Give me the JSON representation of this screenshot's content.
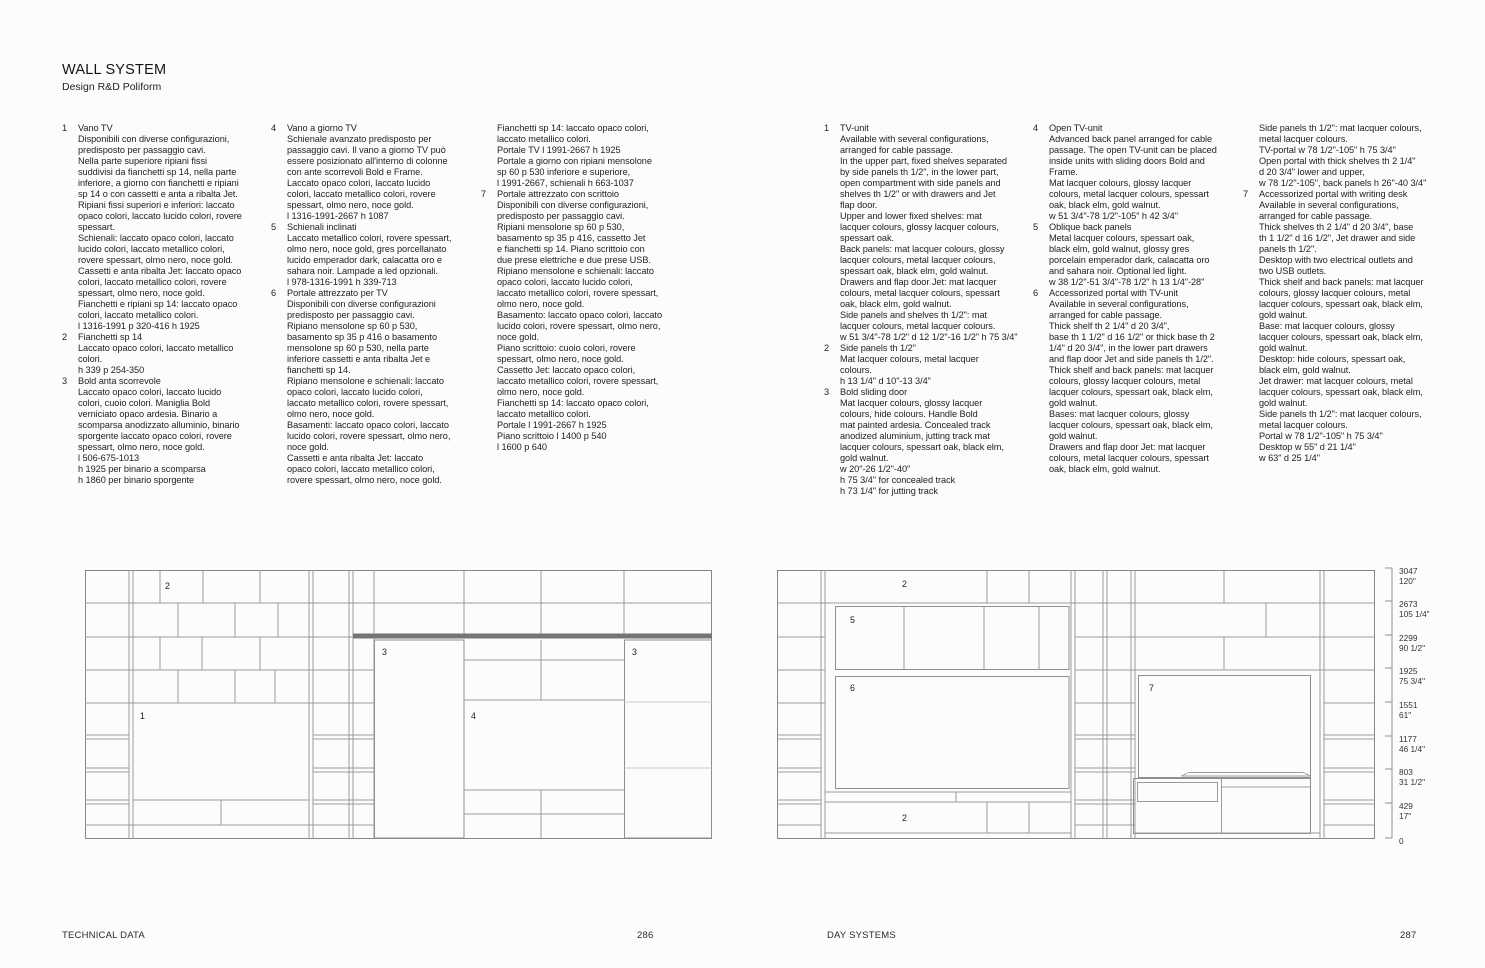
{
  "header": {
    "title": "WALL SYSTEM",
    "subtitle": "Design R&D Poliform"
  },
  "columns": [
    {
      "lang": "it",
      "blocks": [
        {
          "num": "1",
          "lines": [
            "Vano TV",
            "Disponibili con diverse configurazioni,",
            "predisposto per passaggio cavi.",
            "Nella parte superiore ripiani fissi",
            "suddivisi da fianchetti sp 14, nella parte",
            "inferiore, a giorno con fianchetti e ripiani",
            "sp 14 o con cassetti e anta a ribalta Jet.",
            "Ripiani fissi superiori e inferiori: laccato",
            "opaco colori, laccato lucido colori, rovere",
            "spessart.",
            "Schienali: laccato opaco colori, laccato",
            "lucido colori, laccato metallico colori,",
            "rovere spessart, olmo nero, noce gold.",
            "Cassetti e anta ribalta Jet: laccato opaco",
            "colori, laccato metallico colori, rovere",
            "spessart, olmo nero, noce gold.",
            "Fianchetti e ripiani sp 14: laccato opaco",
            "colori, laccato metallico colori.",
            "l 1316-1991 p 320-416 h 1925"
          ]
        },
        {
          "num": "2",
          "lines": [
            "Fianchetti sp 14",
            "Laccato opaco colori, laccato metallico",
            "colori.",
            "h 339 p 254-350"
          ]
        },
        {
          "num": "3",
          "lines": [
            "Bold anta scorrevole",
            "Laccato opaco colori, laccato lucido",
            "colori, cuoio colori. Maniglia Bold",
            "verniciato opaco ardesia. Binario a",
            "scomparsa anodizzato alluminio, binario",
            "sporgente laccato opaco colori, rovere",
            "spessart, olmo nero, noce gold.",
            "l 506-675-1013",
            "h 1925 per binario a scomparsa",
            "h 1860 per binario sporgente"
          ]
        }
      ]
    },
    {
      "lang": "it",
      "blocks": [
        {
          "num": "4",
          "lines": [
            "Vano a giorno TV",
            "Schienale avanzato predisposto per",
            "passaggio cavi. Il vano a giorno TV può",
            "essere posizionato all'interno di colonne",
            "con ante scorrevoli Bold e Frame.",
            "Laccato opaco colori, laccato lucido",
            "colori, laccato metallico colori, rovere",
            "spessart, olmo nero, noce gold.",
            "l 1316-1991-2667 h 1087"
          ]
        },
        {
          "num": "5",
          "lines": [
            "Schienali inclinati",
            "Laccato metallico colori, rovere spessart,",
            "olmo nero, noce gold, gres porcellanato",
            "lucido emperador dark, calacatta oro e",
            "sahara noir. Lampade a led opzionali.",
            "l 978-1316-1991 h 339-713"
          ]
        },
        {
          "num": "6",
          "lines": [
            "Portale attrezzato per TV",
            "Disponibili con diverse configurazioni",
            "predisposto per passaggio cavi.",
            "Ripiano mensolone sp 60 p 530,",
            "basamento sp 35 p 416 o basamento",
            "mensolone sp 60 p 530, nella parte",
            "inferiore cassetti e anta ribalta Jet e",
            "fianchetti sp 14.",
            "Ripiano mensolone e schienali: laccato",
            "opaco colori, laccato lucido colori,",
            "laccato metallico colori, rovere spessart,",
            "olmo nero, noce gold.",
            "Basamenti: laccato opaco colori, laccato",
            "lucido colori, rovere spessart, olmo nero,",
            "noce gold.",
            "Cassetti e anta ribalta Jet: laccato",
            "opaco colori, laccato metallico colori,",
            "rovere spessart, olmo nero, noce gold."
          ]
        }
      ]
    },
    {
      "lang": "it",
      "blocks": [
        {
          "num": "",
          "lines": [
            "Fianchetti sp 14: laccato opaco colori,",
            "laccato metallico colori.",
            "Portale TV l 1991-2667 h 1925",
            "Portale a giorno con ripiani mensolone",
            "sp 60 p 530 inferiore e superiore,",
            "l 1991-2667, schienali h 663-1037"
          ]
        },
        {
          "num": "7",
          "lines": [
            "Portale attrezzato con scrittoio",
            "Disponibili con diverse configurazioni,",
            "predisposto per passaggio cavi.",
            "Ripiani mensolone sp 60 p 530,",
            "basamento sp 35 p 416, cassetto Jet",
            "e fianchetti sp 14. Piano scrittoio con",
            "due prese elettriche e due prese USB.",
            "Ripiano mensolone e schienali: laccato",
            "opaco colori, laccato lucido colori,",
            "laccato metallico colori, rovere spessart,",
            "olmo nero, noce gold.",
            "Basamento: laccato opaco colori, laccato",
            "lucido colori, rovere spessart, olmo nero,",
            "noce gold.",
            "Piano scrittoio: cuoio colori, rovere",
            "spessart, olmo nero, noce gold.",
            "Cassetto Jet: laccato opaco colori,",
            "laccato metallico colori, rovere spessart,",
            "olmo nero, noce gold.",
            "Fianchetti sp 14: laccato opaco colori,",
            "laccato metallico colori.",
            "Portale l 1991-2667 h 1925",
            "Piano scrittoio l 1400 p 540",
            "l 1600 p 640"
          ]
        }
      ]
    },
    {
      "lang": "en",
      "blocks": [
        {
          "num": "1",
          "lines": [
            "TV-unit",
            "Available with several configurations,",
            "arranged for cable passage.",
            "In the upper part, fixed shelves separated",
            "by side panels th 1/2\", in the lower part,",
            "open compartment with side panels and",
            "shelves th 1/2\" or with drawers and Jet",
            "flap door.",
            "Upper and lower fixed shelves: mat",
            "lacquer colours, glossy lacquer colours,",
            "spessart oak.",
            "Back panels: mat lacquer colours, glossy",
            "lacquer colours, metal lacquer colours,",
            "spessart oak, black elm, gold walnut.",
            "Drawers and flap door Jet: mat lacquer",
            "colours, metal lacquer colours, spessart",
            "oak, black elm, gold walnut.",
            "Side panels and shelves th 1/2\": mat",
            "lacquer colours, metal lacquer colours.",
            "w 51 3/4\"-78 1/2\" d 12 1/2\"-16 1/2\" h 75 3/4\""
          ]
        },
        {
          "num": "2",
          "lines": [
            "Side panels th 1/2\"",
            "Mat lacquer colours, metal lacquer",
            "colours.",
            "h 13 1/4\" d 10\"-13 3/4\""
          ]
        },
        {
          "num": "3",
          "lines": [
            "Bold sliding door",
            "Mat lacquer colours, glossy lacquer",
            "colours, hide colours. Handle Bold",
            "mat painted ardesia. Concealed track",
            "anodized aluminium, jutting track mat",
            "lacquer colours, spessart oak, black elm,",
            "gold walnut.",
            "w 20\"-26 1/2\"-40\"",
            "h 75 3/4\" for concealed track",
            "h 73 1/4\" for jutting track"
          ]
        }
      ]
    },
    {
      "lang": "en",
      "blocks": [
        {
          "num": "4",
          "lines": [
            "Open TV-unit",
            "Advanced back panel arranged for cable",
            "passage. The open TV-unit can be placed",
            "inside units with sliding doors Bold and",
            "Frame.",
            "Mat lacquer colours, glossy lacquer",
            "colours, metal lacquer colours, spessart",
            "oak, black elm, gold walnut.",
            "w 51 3/4\"-78 1/2\"-105\" h 42 3/4\""
          ]
        },
        {
          "num": "5",
          "lines": [
            "Oblique back panels",
            "Metal lacquer colours, spessart oak,",
            "black elm, gold walnut, glossy gres",
            "porcelain emperador dark, calacatta oro",
            "and sahara noir. Optional led light.",
            "w 38 1/2\"-51 3/4\"-78 1/2\" h 13 1/4\"-28\""
          ]
        },
        {
          "num": "6",
          "lines": [
            "Accessorized portal with TV-unit",
            "Available in several configurations,",
            "arranged for cable passage.",
            "Thick shelf th 2 1/4\" d 20 3/4\",",
            "base th 1 1/2\" d 16 1/2\" or thick base th 2",
            "1/4\" d 20 3/4\", in the lower part drawers",
            "and flap door Jet and side panels th 1/2\".",
            "Thick shelf and back panels: mat lacquer",
            "colours, glossy lacquer colours, metal",
            "lacquer colours, spessart oak, black elm,",
            "gold walnut.",
            "Bases: mat lacquer colours, glossy",
            "lacquer colours, spessart oak, black elm,",
            "gold walnut.",
            "Drawers and flap door Jet: mat lacquer",
            "colours, metal lacquer colours, spessart",
            "oak, black elm, gold walnut."
          ]
        }
      ]
    },
    {
      "lang": "en",
      "blocks": [
        {
          "num": "",
          "lines": [
            "Side panels th 1/2\": mat lacquer colours,",
            "metal lacquer colours.",
            "TV-portal w 78 1/2\"-105\" h 75 3/4\"",
            "Open portal with thick shelves th 2 1/4\"",
            "d 20 3/4\" lower and upper,",
            "w 78 1/2\"-105\", back panels h 26\"-40 3/4\""
          ]
        },
        {
          "num": "7",
          "lines": [
            "Accessorized portal with writing desk",
            "Available in several configurations,",
            "arranged for cable passage.",
            "Thick shelves th 2 1/4\" d 20 3/4\", base",
            "th 1 1/2\" d 16 1/2\", Jet drawer and side",
            "panels th 1/2\".",
            "Desktop with two electrical outlets and",
            "two USB outlets.",
            "Thick shelf and back panels: mat lacquer",
            "colours, glossy lacquer colours, metal",
            "lacquer colours, spessart oak, black elm,",
            "gold walnut.",
            "Base: mat lacquer colours, glossy",
            "lacquer colours, spessart oak, black elm,",
            "gold walnut.",
            "Desktop: hide colours, spessart oak,",
            "black elm, gold walnut.",
            "Jet drawer: mat lacquer colours, metal",
            "lacquer colours, spessart oak, black elm,",
            "gold walnut.",
            "Side panels th 1/2\": mat lacquer colours,",
            "metal lacquer colours.",
            "Portal w 78 1/2\"-105\" h 75 3/4\"",
            "Desktop w 55\" d 21 1/4\"",
            "w 63\" d 25 1/4\""
          ]
        }
      ]
    }
  ],
  "drawings": {
    "left": {
      "labels": [
        {
          "t": "2"
        },
        {
          "t": "1"
        },
        {
          "t": "3"
        },
        {
          "t": "4"
        },
        {
          "t": "3"
        }
      ]
    },
    "right": {
      "labels": [
        {
          "t": "2"
        },
        {
          "t": "5"
        },
        {
          "t": "6"
        },
        {
          "t": "7"
        },
        {
          "t": "2"
        }
      ]
    }
  },
  "scale": {
    "marks": [
      {
        "mm": "3047",
        "in": "120\""
      },
      {
        "mm": "2673",
        "in": "105 1/4\""
      },
      {
        "mm": "2299",
        "in": "90 1/2\""
      },
      {
        "mm": "1925",
        "in": "75 3/4\""
      },
      {
        "mm": "1551",
        "in": "61\""
      },
      {
        "mm": "1177",
        "in": "46 1/4\""
      },
      {
        "mm": "803",
        "in": "31 1/2\""
      },
      {
        "mm": "429",
        "in": "17\""
      },
      {
        "mm": "0",
        "in": ""
      }
    ]
  },
  "footer": {
    "left": "TECHNICAL DATA",
    "page_left": "286",
    "right": "DAY SYSTEMS",
    "page_right": "287"
  }
}
